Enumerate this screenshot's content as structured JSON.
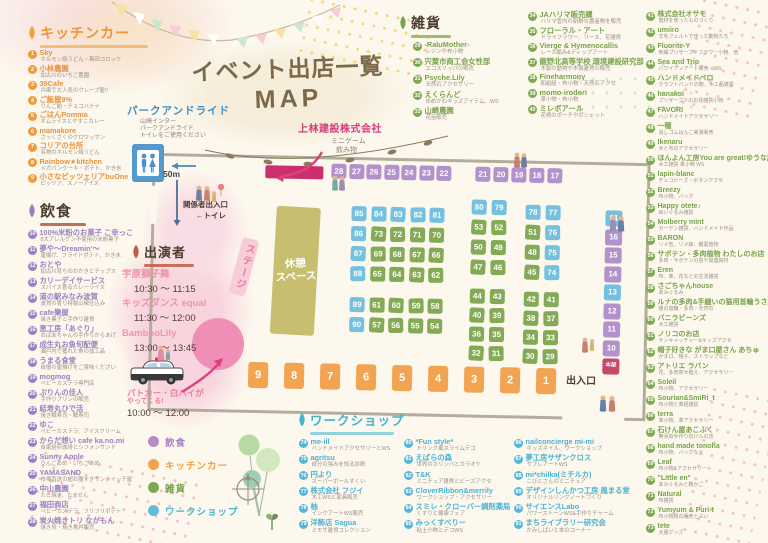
{
  "title": {
    "line1": "イベント出店一覧",
    "line2": "MAP"
  },
  "park_and_ride": {
    "heading": "パークアンドライド",
    "lines": [
      "山崎インター",
      "パークアンドライド",
      "トイレをご使用ください"
    ],
    "distance": "50m"
  },
  "sponsor": {
    "name": "上林建設株式会社",
    "item1": "ミニゲーム",
    "item2": "飲み物"
  },
  "performers": {
    "heading": "出演者",
    "schedule": [
      {
        "name": "宇原獅子舞",
        "time": "10:30 〜 11:15"
      },
      {
        "name": "キッズダンス equal",
        "time": "11:30 〜 12:00"
      },
      {
        "name": "BambooLily",
        "time": "13:00 〜 13:45"
      }
    ]
  },
  "police": {
    "line1": "パトカー・白バイが",
    "line2": "やってくる!",
    "time": "10:00 〜 12:00"
  },
  "legend": {
    "items": [
      {
        "label": "飲食",
        "c": "p"
      },
      {
        "label": "キッチンカー",
        "c": "o"
      },
      {
        "label": "雑貨",
        "c": "g"
      },
      {
        "label": "ワークショップ",
        "c": "b"
      }
    ]
  },
  "map": {
    "labels": {
      "stage": "ステージ",
      "rest_l1": "休憩",
      "rest_l2": "スペース",
      "staff_entrance": "関係者出入口",
      "toilet": "←トイレ",
      "exit": "出入口"
    },
    "blocks": {
      "top1": [
        {
          "n": "28",
          "c": "p"
        },
        {
          "n": "27",
          "c": "p"
        },
        {
          "n": "26",
          "c": "p"
        },
        {
          "n": "25",
          "c": "p"
        },
        {
          "n": "24",
          "c": "p"
        },
        {
          "n": "23",
          "c": "p"
        },
        {
          "n": "22",
          "c": "p"
        }
      ],
      "top2": [
        {
          "n": "21",
          "c": "p"
        },
        {
          "n": "20",
          "c": "p"
        },
        {
          "n": "19",
          "c": "p"
        },
        {
          "n": "18",
          "c": "p"
        },
        {
          "n": "17",
          "c": "p"
        }
      ],
      "a1": [
        {
          "n": "85",
          "c": "b"
        },
        {
          "n": "84",
          "c": "b"
        },
        {
          "n": "83",
          "c": "b"
        },
        {
          "n": "82",
          "c": "b"
        },
        {
          "n": "81",
          "c": "b"
        },
        {
          "n": "86",
          "c": "b"
        },
        {
          "n": "73",
          "c": "g"
        },
        {
          "n": "72",
          "c": "g"
        },
        {
          "n": "71",
          "c": "g"
        },
        {
          "n": "70",
          "c": "g"
        },
        {
          "n": "87",
          "c": "b"
        },
        {
          "n": "69",
          "c": "g"
        },
        {
          "n": "68",
          "c": "g"
        },
        {
          "n": "67",
          "c": "g"
        },
        {
          "n": "66",
          "c": "g"
        },
        {
          "n": "88",
          "c": "b"
        },
        {
          "n": "65",
          "c": "g"
        },
        {
          "n": "64",
          "c": "g"
        },
        {
          "n": "63",
          "c": "g"
        },
        {
          "n": "62",
          "c": "g"
        }
      ],
      "a2": [
        {
          "n": "89",
          "c": "b"
        },
        {
          "n": "61",
          "c": "g"
        },
        {
          "n": "60",
          "c": "g"
        },
        {
          "n": "59",
          "c": "g"
        },
        {
          "n": "58",
          "c": "g"
        },
        {
          "n": "90",
          "c": "b"
        },
        {
          "n": "57",
          "c": "g"
        },
        {
          "n": "56",
          "c": "g"
        },
        {
          "n": "55",
          "c": "g"
        },
        {
          "n": "54",
          "c": "g"
        }
      ],
      "b1": [
        {
          "n": "80",
          "c": "b"
        },
        {
          "n": "79",
          "c": "b"
        },
        {
          "n": "53",
          "c": "g"
        },
        {
          "n": "52",
          "c": "g"
        },
        {
          "n": "50",
          "c": "g"
        },
        {
          "n": "49",
          "c": "g"
        },
        {
          "n": "47",
          "c": "g"
        },
        {
          "n": "46",
          "c": "g"
        }
      ],
      "b2": [
        {
          "n": "44",
          "c": "g"
        },
        {
          "n": "43",
          "c": "g"
        },
        {
          "n": "40",
          "c": "g"
        },
        {
          "n": "39",
          "c": "g"
        },
        {
          "n": "36",
          "c": "g"
        },
        {
          "n": "35",
          "c": "g"
        },
        {
          "n": "32",
          "c": "g"
        },
        {
          "n": "31",
          "c": "g"
        }
      ],
      "c1": [
        {
          "n": "78",
          "c": "b"
        },
        {
          "n": "77",
          "c": "b"
        },
        {
          "n": "51",
          "c": "g"
        },
        {
          "n": "76",
          "c": "b"
        },
        {
          "n": "48",
          "c": "g"
        },
        {
          "n": "75",
          "c": "b"
        },
        {
          "n": "45",
          "c": "g"
        },
        {
          "n": "74",
          "c": "b"
        }
      ],
      "c2": [
        {
          "n": "42",
          "c": "g"
        },
        {
          "n": "41",
          "c": "g"
        },
        {
          "n": "38",
          "c": "g"
        },
        {
          "n": "37",
          "c": "g"
        },
        {
          "n": "34",
          "c": "g"
        },
        {
          "n": "33",
          "c": "g"
        },
        {
          "n": "30",
          "c": "g"
        },
        {
          "n": "29",
          "c": "g"
        }
      ],
      "right": [
        {
          "n": "91",
          "c": "b"
        },
        {
          "n": "16",
          "c": "p"
        },
        {
          "n": "15",
          "c": "p"
        },
        {
          "n": "14",
          "c": "p"
        },
        {
          "n": "13",
          "c": "b"
        },
        {
          "n": "12",
          "c": "p"
        },
        {
          "n": "11",
          "c": "p"
        },
        {
          "n": "10",
          "c": "p"
        },
        {
          "n": "本部",
          "c": "r"
        }
      ],
      "bottom": [
        {
          "n": "9",
          "c": "o"
        },
        {
          "n": "8",
          "c": "o"
        },
        {
          "n": "7",
          "c": "o"
        },
        {
          "n": "6",
          "c": "o"
        },
        {
          "n": "5",
          "c": "o"
        },
        {
          "n": "4",
          "c": "o"
        },
        {
          "n": "3",
          "c": "o"
        },
        {
          "n": "2",
          "c": "o"
        },
        {
          "n": "1",
          "c": "o"
        }
      ]
    }
  },
  "sections": {
    "kitchen": {
      "heading": "キッチンカー",
      "items": [
        {
          "n": "1",
          "name": "Sky",
          "desc": "ホルモン焼うどん・黒田コロッケ"
        },
        {
          "n": "2",
          "name": "小林農園",
          "desc": "加古川のいちご農園"
        },
        {
          "n": "3",
          "name": "39Cafe",
          "desc": "兵庫で大人気のクレープ屋!!"
        },
        {
          "n": "4",
          "name": "ご飯屋9%",
          "desc": "りんご飴・チョコバナナ"
        },
        {
          "n": "5",
          "name": "ごはんPomma",
          "desc": "オムライスとやすこカレー"
        },
        {
          "n": "6",
          "name": "mamakore",
          "desc": "さっくさくのクロワッサン"
        },
        {
          "n": "7",
          "name": "コリアの台所",
          "desc": "名物のホルモン焼うどん"
        },
        {
          "n": "8",
          "name": "Rainbow★kitchen",
          "desc": "メガパンケーキ・ポテト、かき氷"
        },
        {
          "n": "9",
          "name": "小さなピッツェリアbuOne",
          "desc": "ピッツァ、スノーアイス"
        }
      ]
    },
    "food": {
      "heading": "飲食",
      "items": [
        {
          "n": "10",
          "name": "100%米粉のお菓子 こ幸っこ",
          "desc": "8大アレルゲン不使用の米粉菓子"
        },
        {
          "n": "11",
          "name": "夢や〜Dreamin'〜",
          "desc": "唐揚げ、フライドポテト、かき氷"
        },
        {
          "n": "12",
          "name": "おとや",
          "desc": "加古川育ちのおかきとチップス"
        },
        {
          "n": "13",
          "name": "カリーデイサービス",
          "desc": "スパイス香るカレーライス"
        },
        {
          "n": "14",
          "name": "道の駅みなみ波賀",
          "desc": "波賀の香り特製山椒仕込み"
        },
        {
          "n": "15",
          "name": "cafe樂屋",
          "desc": "焼き菓子と手作り雑貨"
        },
        {
          "n": "16",
          "name": "恵工房「あぐり」",
          "desc": "おばあちゃんの手作りからあげ"
        },
        {
          "n": "17",
          "name": "成生丸お魚旬配便",
          "desc": "瀬戸内で獲れた魚の加工品"
        },
        {
          "n": "18",
          "name": "うまる食堂",
          "desc": "自慢の唐揚げをご賞味ください"
        },
        {
          "n": "19",
          "name": "mogmog",
          "desc": "ベビーカステラ専門店"
        },
        {
          "n": "20",
          "name": "ぷりんの佳人",
          "desc": "手作りプリンの販売"
        },
        {
          "n": "21",
          "name": "結寿丸ひで活",
          "desc": "焼き鯖寿司・鯖寿司"
        },
        {
          "n": "22",
          "name": "ゆこ",
          "desc": "ベビーカステラ、アイスクリーム"
        },
        {
          "n": "23",
          "name": "からだ想い cafe ka.no.mi",
          "desc": "自家焙煎珈琲とシフォンサンド"
        },
        {
          "n": "24",
          "name": "Sunny Apple",
          "desc": "りんごあめ・いちごあめ"
        },
        {
          "n": "25",
          "name": "YAMASAND",
          "desc": "市場直送の超お腹すきサンドイッチ屋"
        },
        {
          "n": "26",
          "name": "中山農園",
          "desc": "たこ焼き、たません"
        },
        {
          "n": "27",
          "name": "福田商店",
          "desc": "ベビーカステラ、フリフリポテト"
        },
        {
          "n": "28",
          "name": "炭火焼きトリ なかもん",
          "desc": "焼き鳥・焼き鳥丼販売"
        }
      ]
    },
    "zakka": {
      "heading": "雑貨",
      "col1": [
        {
          "n": "29",
          "name": "-RaluMother-",
          "desc": "レジンや布小物"
        },
        {
          "n": "30",
          "name": "宍粟市商工会女性部",
          "desc": "エコスリッパの販売"
        },
        {
          "n": "31",
          "name": "Psyche.Lily",
          "desc": "天然石アクセサリー"
        },
        {
          "n": "32",
          "name": "えくらんど",
          "desc": "ゆめかわキッズアイテム、WS"
        },
        {
          "n": "33",
          "name": "山崎農園",
          "desc": "花苗販売"
        }
      ],
      "col2": [
        {
          "n": "34",
          "name": "JAハリマ販売課",
          "desc": "ハリマ管内の新鮮な農産物を販売"
        },
        {
          "n": "35",
          "name": "フローラル・アート",
          "desc": "ドライフラワー、リース、花雑貨"
        },
        {
          "n": "36",
          "name": "Vierge & Hymenocallis",
          "desc": "レース編み&ディップアート"
        },
        {
          "n": "37",
          "name": "龍野北高等学校 環境建設研究部",
          "desc": "木製の動物や木製雑貨の販売"
        },
        {
          "n": "38",
          "name": "Fineharmony",
          "desc": "和組紐・布小物・天然石アクセ"
        },
        {
          "n": "39",
          "name": "momo-irodori",
          "desc": "革小物・布小物"
        },
        {
          "n": "40",
          "name": "ミレボアール",
          "desc": "花柄のポーチやポシェット"
        }
      ],
      "col3": [
        {
          "n": "41",
          "name": "株式会社オサモ",
          "desc": "廃材を使ったものづくり"
        },
        {
          "n": "42",
          "name": "umiiro",
          "desc": "羊毛フェルトで作った動物たち"
        },
        {
          "n": "43",
          "name": "Fluorite-Y",
          "desc": "刺繍プリザーブドフラワー小物、他"
        },
        {
          "n": "44",
          "name": "Sea and Trip",
          "desc": "ハワイアンアート販売・WS"
        },
        {
          "n": "45",
          "name": "ハンドメイドペロ",
          "desc": "クラフトバンドの鞄、木工品雑貨"
        },
        {
          "n": "46",
          "name": "hanakoi",
          "desc": "プリザーブドのお花雑貨小物"
        },
        {
          "n": "47",
          "name": "FAVORI",
          "desc": "ハンドメイドアクセサリー"
        },
        {
          "n": "48",
          "name": "一穂",
          "desc": "消しゴムはんこ実演販売"
        },
        {
          "n": "49",
          "name": "Ikenaru",
          "desc": "木と布のアクセサリー"
        },
        {
          "n": "50",
          "name": "ほんよん工房You are great!ゆうな応援団",
          "desc": "木工雑貨 革小物 WS"
        },
        {
          "n": "51",
          "name": "lapin-blanc",
          "desc": "チェコビーズ・ボタンアクセ"
        },
        {
          "n": "52",
          "name": "Breezy",
          "desc": "布小物、バッグ"
        },
        {
          "n": "53",
          "name": "Happy otete♪",
          "desc": "ぬいぐるみ雑貨"
        },
        {
          "n": "54",
          "name": "Molberry mint",
          "desc": "ガーデン雑貨、ハンドメイド作品"
        },
        {
          "n": "55",
          "name": "BARON",
          "desc": "リメ缶、リメ鉢、観葉植物"
        },
        {
          "n": "56",
          "name": "サボテン・多肉植物 わたしのお店",
          "desc": "多肉・サボテンの苗や関連資材"
        },
        {
          "n": "57",
          "name": "Eren",
          "desc": "布、革、花などの生活雑貨"
        },
        {
          "n": "58",
          "name": "さごちゃんhouse",
          "desc": "あみぐるみ"
        },
        {
          "n": "59",
          "name": "ルナの多肉&手縫いの猫用首輪うさ屋",
          "desc": "猫の首輪・多肉・天然石"
        },
        {
          "n": "60",
          "name": "バニラビーンズ",
          "desc": "木工雑貨"
        },
        {
          "n": "61",
          "name": "ノリコのお店",
          "desc": "サンキャッチャー&キッズアクセ"
        },
        {
          "n": "62",
          "name": "帽子好きな がま口屋さん あちゅ",
          "desc": "がま口、帽子、ストラップなど"
        },
        {
          "n": "63",
          "name": "アトリエ ラバン",
          "desc": "花、多肉寄せ植え、アクセサリー"
        },
        {
          "n": "64",
          "name": "Soleil",
          "desc": "布小物、アクセサリー"
        },
        {
          "n": "65",
          "name": "Sourian&SmiRi_t",
          "desc": "布小物と革紐雑貨"
        },
        {
          "n": "66",
          "name": "terra",
          "desc": "革小物、革アクセサリー"
        },
        {
          "n": "67",
          "name": "石けん屋あこふく",
          "desc": "無添加手作り石けんの店"
        },
        {
          "n": "68",
          "name": "hand made tonoha",
          "desc": "布小物、バッグなど"
        },
        {
          "n": "69",
          "name": "Leaf",
          "desc": "布小物&アクセサリー"
        },
        {
          "n": "70",
          "name": "\"Little en\"",
          "desc": "あみぐるみと鞄かご"
        },
        {
          "n": "71",
          "name": "Natural",
          "desc": "布雑貨"
        },
        {
          "n": "72",
          "name": "Yumyum & Puri-t",
          "desc": "布小物類の販売と占い"
        },
        {
          "n": "73",
          "name": "tete",
          "desc": "犬服グッズ"
        }
      ]
    },
    "workshop": {
      "heading": "ワークショップ",
      "col1": [
        {
          "n": "74",
          "name": "me-ill",
          "desc": "ハンドメイドアクセサリーとWS"
        },
        {
          "n": "75",
          "name": "agritsu",
          "desc": "自分の強みを知る診断"
        },
        {
          "n": "76",
          "name": "円より",
          "desc": "スーパーボールすくい"
        },
        {
          "n": "77",
          "name": "株式会社 フジイ",
          "desc": "木工WSと家具販売"
        },
        {
          "n": "78",
          "name": "柚",
          "desc": "インクアートWS販売"
        },
        {
          "n": "79",
          "name": "洋飾店 Sagua",
          "desc": "ミモザ雑貨コレクション"
        }
      ],
      "col2": [
        {
          "n": "80",
          "name": "*Fun style*",
          "desc": "ドリンク風スライムデコ"
        },
        {
          "n": "81",
          "name": "えばらの森",
          "desc": "世界のカリンバとカラオケ"
        },
        {
          "n": "82",
          "name": "T&K",
          "desc": "ミニチュア雑貨とビーズアクセ"
        },
        {
          "n": "83",
          "name": "CloverRibbon&merrily",
          "desc": "ワークショップ・アクセサリー"
        },
        {
          "n": "84",
          "name": "スミレ・クローバー調剤薬局",
          "desc": "くすりと健康フェア"
        },
        {
          "n": "85",
          "name": "みっくすべりー",
          "desc": "粘土小物とデコWS"
        }
      ],
      "col3": [
        {
          "n": "86",
          "name": "nailconcierge mi-mi",
          "desc": "キッズネイル、ワークショップ"
        },
        {
          "n": "87",
          "name": "夢工房サザンクロス",
          "desc": "サブレアートWS"
        },
        {
          "n": "88",
          "name": "mi*chilka(ミチルカ)",
          "desc": "こびとさんのミニチュア"
        },
        {
          "n": "89",
          "name": "デザインしんかつ工房 風まる堂",
          "desc": "オリジナルリングノートづくり"
        },
        {
          "n": "90",
          "name": "サイエンスLabo",
          "desc": "パワーストーンWS&手作りチャーム"
        },
        {
          "n": "91",
          "name": "まちライブラリー研究会",
          "desc": "かみしばいと本のコーナー"
        }
      ]
    }
  }
}
